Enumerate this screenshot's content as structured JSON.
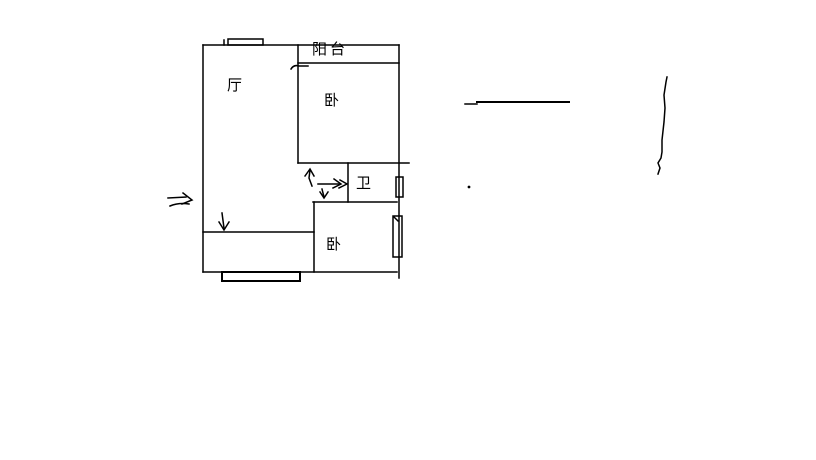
{
  "canvas": {
    "background_color": "#ffffff",
    "line_color": "#000000"
  },
  "floor_plan": {
    "labels": {
      "balcony": "阳台",
      "living_room": "厅",
      "bedroom_top": "卧",
      "bathroom": "卫",
      "bedroom_bottom": "卧"
    }
  }
}
